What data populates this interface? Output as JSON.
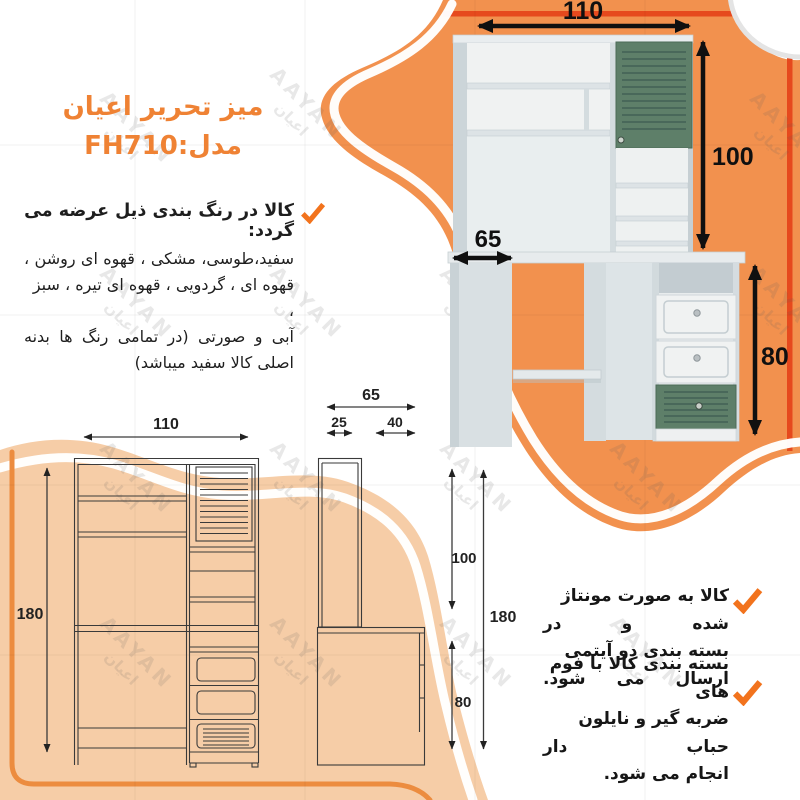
{
  "title": {
    "product": "میز تحریر اعیان",
    "model": "مدل:FH710"
  },
  "color_note": {
    "heading": "کالا در رنگ بندی ذیل عرضه می گردد:",
    "lines": [
      "سفید،طوسی، مشکی ، قهوه ای روشن ،",
      "قهوه ای ، گردویی ، قهوه ای تیره ، سبز ،",
      "آبی و صورتی (در تمامی رنگ ها بدنه",
      "اصلی کالا سفید میباشد)"
    ]
  },
  "bullets": [
    {
      "lines": [
        "کالا به صورت مونتاژ شده و در",
        "بسته بندی دو آیتمی ارسال می شود."
      ]
    },
    {
      "lines": [
        "بسته بندی کالا با فوم های",
        "ضربه گیر و نایلون حباب دار",
        "انجام می شود."
      ]
    }
  ],
  "dimensions": {
    "photo": {
      "width": "110",
      "hutch_height": "100",
      "depth": "65",
      "desk_height": "80"
    },
    "front_view": {
      "width": "110",
      "height": "180"
    },
    "side_view": {
      "depth": "65",
      "hutch_depth": "25",
      "desk_extra_depth": "40",
      "hutch_height": "100",
      "desk_height": "80",
      "height": "180"
    }
  },
  "watermark": {
    "latin": "AAYAN",
    "arabic": "اعيان"
  },
  "colors": {
    "orange": "#F2914E",
    "orange_light": "#F6CDA7",
    "accent": "#E6491D",
    "green": "#5E7F69",
    "title": "#EF8234"
  }
}
